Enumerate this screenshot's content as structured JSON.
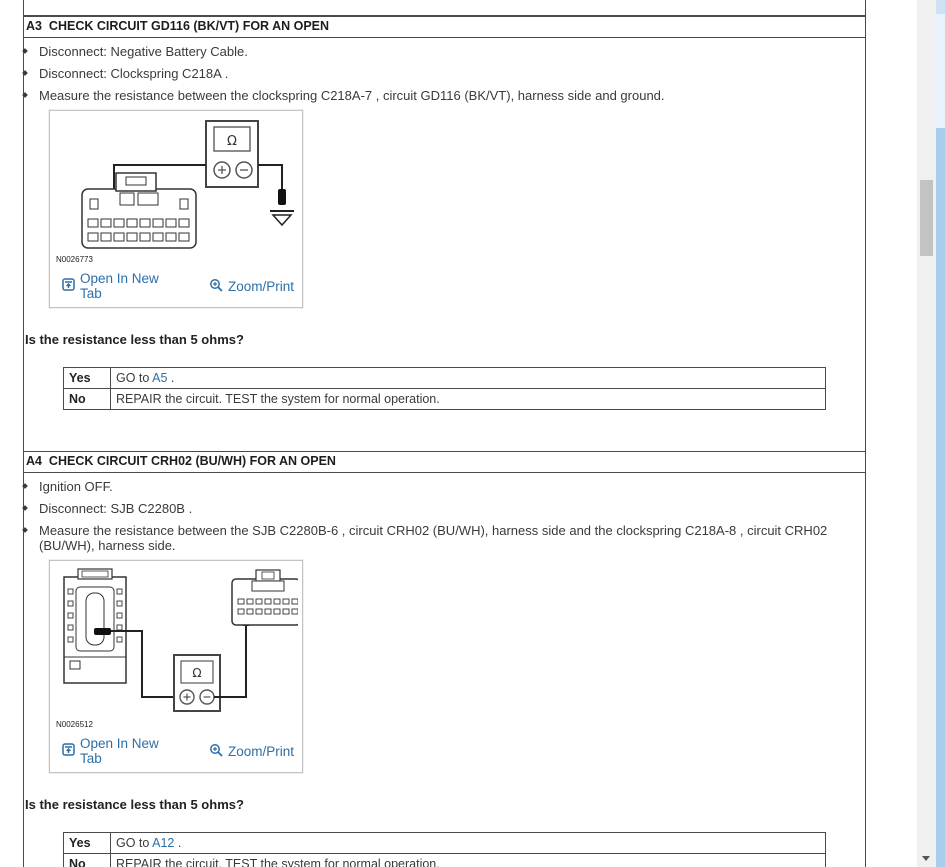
{
  "colors": {
    "link_blue": "#2b6fa8",
    "border_dark": "#4b4b4b",
    "figure_border": "#c3c3c3",
    "inner_scroll_track": "#f0f0f0",
    "inner_scroll_thumb": "#c3c3c3",
    "page_scroll_track": "#e9f2fc",
    "page_scroll_thumb": "#a9cdee"
  },
  "steps": [
    {
      "title": "A3  CHECK CIRCUIT GD116 (BK/VT) FOR AN OPEN",
      "bullets": [
        "Disconnect: Negative Battery Cable.",
        "Disconnect: Clockspring C218A .",
        "Measure the resistance between the clockspring C218A-7 , circuit GD116 (BK/VT), harness side and ground."
      ],
      "figure": {
        "label": "N0026773",
        "open_in_new_tab": "Open In New Tab",
        "zoom_print": "Zoom/Print",
        "meter_symbol": "Ω"
      },
      "question": "Is the resistance less than 5 ohms?",
      "answers": [
        {
          "label": "Yes",
          "pre": "GO to ",
          "link": "A5",
          "post": " ."
        },
        {
          "label": "No",
          "pre": "REPAIR the circuit. TEST the system for normal operation.",
          "link": "",
          "post": ""
        }
      ]
    },
    {
      "title": "A4  CHECK CIRCUIT CRH02 (BU/WH) FOR AN OPEN",
      "bullets": [
        "Ignition OFF.",
        "Disconnect: SJB C2280B .",
        "Measure the resistance between the SJB C2280B-6 , circuit CRH02 (BU/WH), harness side and the clockspring C218A-8 , circuit CRH02 (BU/WH), harness side."
      ],
      "figure": {
        "label": "N0026512",
        "open_in_new_tab": "Open In New Tab",
        "zoom_print": "Zoom/Print",
        "meter_symbol": "Ω"
      },
      "question": "Is the resistance less than 5 ohms?",
      "answers": [
        {
          "label": "Yes",
          "pre": "GO to ",
          "link": "A12",
          "post": " ."
        },
        {
          "label": "No",
          "pre": "REPAIR the circuit. TEST the system for normal operation.",
          "link": "",
          "post": ""
        }
      ]
    }
  ]
}
